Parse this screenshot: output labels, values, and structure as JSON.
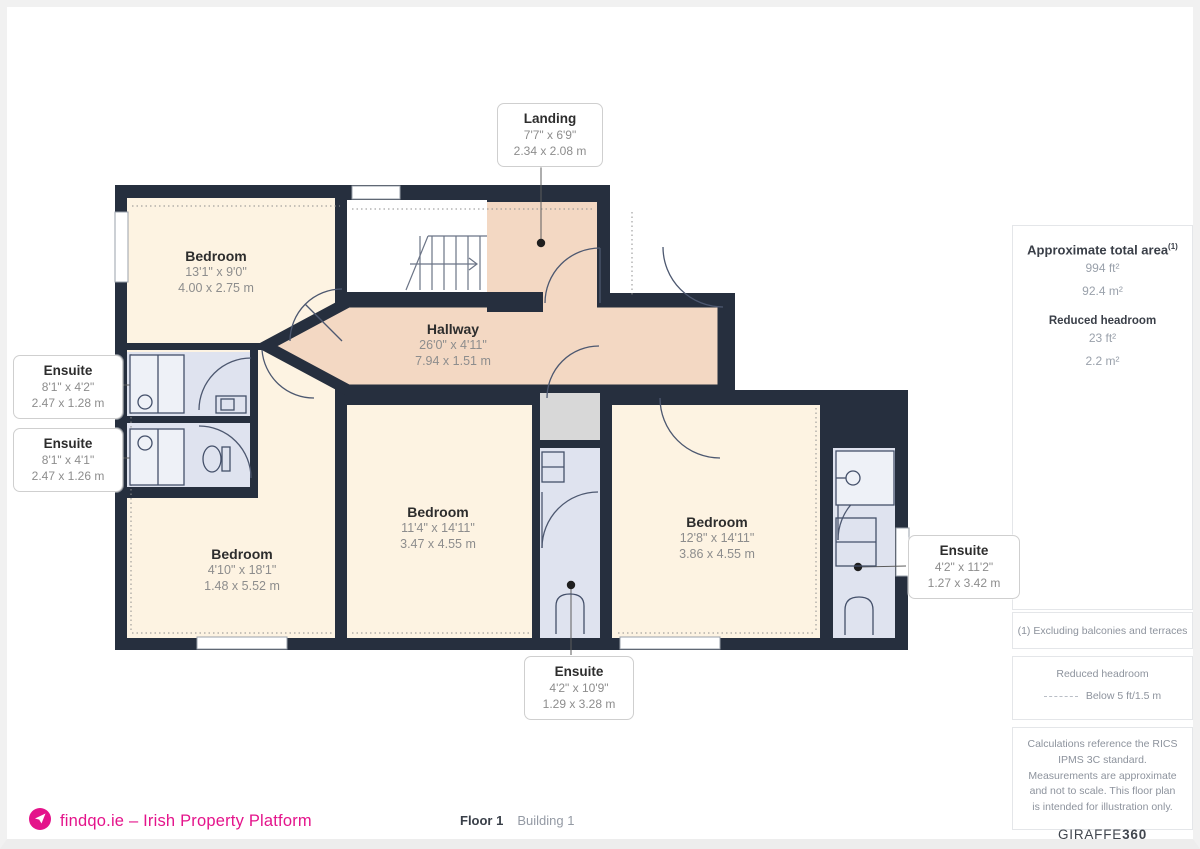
{
  "floorplan": {
    "rooms": {
      "landing": {
        "name": "Landing",
        "dims_ft": "7'7\" x 6'9\"",
        "dims_m": "2.34 x 2.08 m"
      },
      "hallway": {
        "name": "Hallway",
        "dims_ft": "26'0\" x 4'11\"",
        "dims_m": "7.94 x 1.51 m"
      },
      "bedroom_tl": {
        "name": "Bedroom",
        "dims_ft": "13'1\" x 9'0\"",
        "dims_m": "4.00 x 2.75 m"
      },
      "bedroom_bl": {
        "name": "Bedroom",
        "dims_ft": "4'10\" x 18'1\"",
        "dims_m": "1.48 x 5.52 m"
      },
      "bedroom_c": {
        "name": "Bedroom",
        "dims_ft": "11'4\" x 14'11\"",
        "dims_m": "3.47 x 4.55 m"
      },
      "bedroom_r": {
        "name": "Bedroom",
        "dims_ft": "12'8\" x 14'11\"",
        "dims_m": "3.86 x 4.55 m"
      },
      "ensuite_l1": {
        "name": "Ensuite",
        "dims_ft": "8'1\" x 4'2\"",
        "dims_m": "2.47 x 1.28 m"
      },
      "ensuite_l2": {
        "name": "Ensuite",
        "dims_ft": "8'1\" x 4'1\"",
        "dims_m": "2.47 x 1.26 m"
      },
      "ensuite_c": {
        "name": "Ensuite",
        "dims_ft": "4'2\" x 10'9\"",
        "dims_m": "1.29 x 3.28 m"
      },
      "ensuite_r": {
        "name": "Ensuite",
        "dims_ft": "4'2\" x 11'2\"",
        "dims_m": "1.27 x 3.42 m"
      }
    }
  },
  "sidebar": {
    "total_area": {
      "title": "Approximate total area",
      "sup": "(1)",
      "ft": "994 ft²",
      "m": "92.4 m²"
    },
    "reduced_headroom": {
      "title": "Reduced headroom",
      "ft": "23 ft²",
      "m": "2.2 m²"
    },
    "note_excluding": "(1) Excluding balconies and terraces",
    "legend": {
      "title": "Reduced headroom",
      "label": "Below 5 ft/1.5 m"
    },
    "disclaimer": "Calculations reference the RICS IPMS 3C standard. Measurements are approximate and not to scale. This floor plan is intended for illustration only.",
    "brand": {
      "name": "GIRAFFE",
      "suffix": "360"
    }
  },
  "footer": {
    "logo_text": "findqo.ie – Irish Property Platform",
    "floor_label": "Floor 1",
    "building_label": "Building 1"
  },
  "colors": {
    "wall": "#262f3e",
    "bedroom_fill": "#fdf3e2",
    "hallway_fill": "#f3d8c3",
    "ensuite_fill": "#dfe3ef",
    "vestibule_fill": "#d8d8d8",
    "accent_pink": "#e4148b",
    "text_dark": "#2d2d2d",
    "text_gray": "#8d939d"
  }
}
